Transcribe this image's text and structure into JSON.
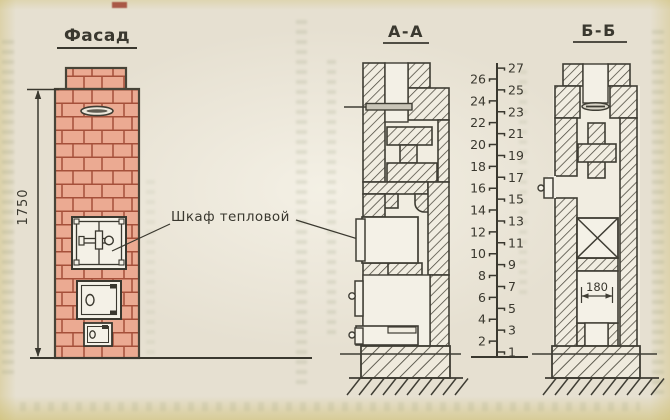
{
  "facade": {
    "title": "Фасад",
    "height_dimension": "1750"
  },
  "callout": {
    "label": "Шкаф тепловой"
  },
  "section_aa": {
    "title": "А-А"
  },
  "section_bb": {
    "title": "Б-Б",
    "width_dimension": "180"
  },
  "course_scale": {
    "left_numbers": [
      26,
      24,
      22,
      20,
      18,
      16,
      14,
      12,
      10,
      8,
      6,
      4,
      2
    ],
    "right_numbers": [
      27,
      25,
      23,
      21,
      19,
      17,
      15,
      13,
      11,
      9,
      7,
      5,
      3,
      1
    ]
  },
  "colors": {
    "paper": "#e6e0d1",
    "drawing_paper": "#f1ede1",
    "ink": "#3f3d34",
    "brick_fill": "#ebaa92",
    "brick_mortar": "#a5503a",
    "door_fill": "#f4f1e7",
    "edge_tint": "#ccbc68"
  }
}
